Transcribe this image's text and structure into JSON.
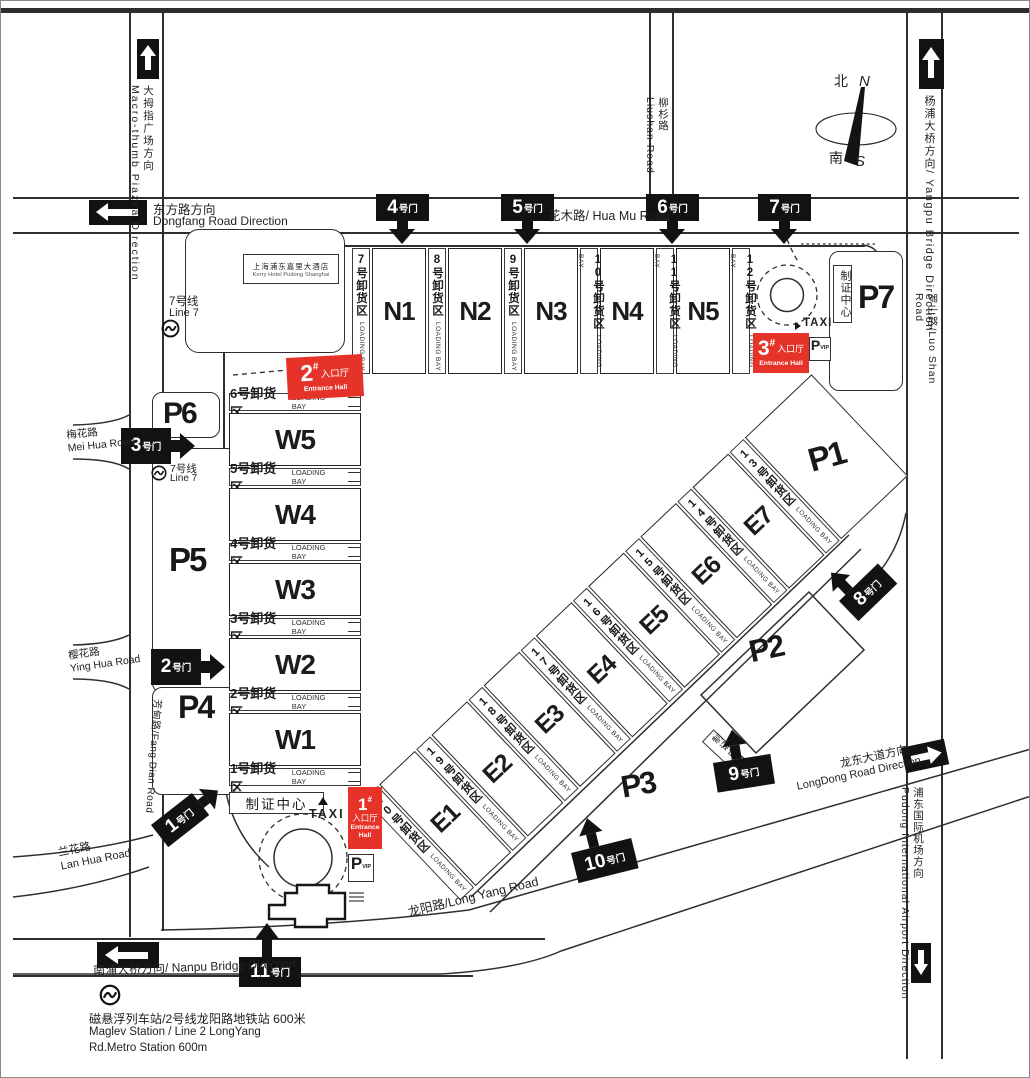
{
  "colors": {
    "red": "#e5332a",
    "ink": "#121212"
  },
  "compass": {
    "north_cn": "北",
    "north_en": "N",
    "south_cn": "南",
    "south_en": "S"
  },
  "roads": {
    "macro_thumb": "大拇指广场方向\nMacro-thumb Piazza Direction",
    "dongfang_cn": "东方路方向",
    "dongfang_en": "Dongfang Road Direction",
    "huamu": "花木路/ Hua Mu Road",
    "liushan": "柳杉路\nLiushan Road",
    "yangpu": "杨浦大桥方向/ Yangpu Bridge Direction",
    "luoshan": "罗山路/Luo Shan Road",
    "meihua": "梅花路\nMei Hua Road",
    "yinghua": "樱花路\nYing Hua Road",
    "fangdian": "芳甸路/Fang Dian Road",
    "lanhua": "兰花路\nLan Hua Road",
    "nanpu": "南浦大桥方向/ Nanpu Bridge Direction",
    "longyang": "龙阳路/Long Yang Road",
    "longdong_cn": "龙东大道方向",
    "longdong_en": "LongDong Road Direction",
    "airport": "浦东国际机场方向\nPudong International Airport Direction"
  },
  "landmarks": {
    "hotel_cn": "上海浦东嘉里大酒店",
    "hotel_en": "Kerry Hotel Pudong Shanghai",
    "line7_cn": "7号线",
    "line7_en": "Line 7",
    "maglev_cn": "磁悬浮列车站/2号线龙阳路地铁站  600米",
    "maglev_en1": "Maglev Station  / Line 2 LongYang",
    "maglev_en2": "Rd.Metro Station 600m",
    "taxi": "TAXI",
    "badge_center": "制证中心",
    "vip_p": "P",
    "vip": "VIP"
  },
  "parking": {
    "p1": "P1",
    "p2": "P2",
    "p3": "P3",
    "p4": "P4",
    "p5": "P5",
    "p6": "P6",
    "p7": "P7"
  },
  "halls": {
    "n": [
      "N1",
      "N2",
      "N3",
      "N4",
      "N5"
    ],
    "w": [
      "W5",
      "W4",
      "W3",
      "W2",
      "W1"
    ],
    "e": [
      "E1",
      "E2",
      "E3",
      "E4",
      "E5",
      "E6",
      "E7"
    ]
  },
  "bays": {
    "n": [
      {
        "cn": "7号卸货区",
        "en": "LOADING BAY"
      },
      {
        "cn": "8号卸货区",
        "en": "LOADING BAY"
      },
      {
        "cn": "9号卸货区",
        "en": "LOADING BAY"
      },
      {
        "cn": "10号卸货区",
        "en": "LOADING BAY"
      },
      {
        "cn": "11号卸货区",
        "en": "LOADING BAY"
      },
      {
        "cn": "12号卸货区",
        "en": "LOADING BAY"
      }
    ],
    "w": [
      {
        "cn": "6号卸货区",
        "en": "LOADING BAY"
      },
      {
        "cn": "5号卸货区",
        "en": "LOADING BAY"
      },
      {
        "cn": "4号卸货区",
        "en": "LOADING BAY"
      },
      {
        "cn": "3号卸货区",
        "en": "LOADING BAY"
      },
      {
        "cn": "2号卸货区",
        "en": "LOADING BAY"
      },
      {
        "cn": "1号卸货区",
        "en": "LOADING BAY"
      }
    ],
    "e": [
      {
        "cn": "20号卸货区",
        "en": "LOADING BAY"
      },
      {
        "cn": "19号卸货区",
        "en": "LOADING BAY"
      },
      {
        "cn": "18号卸货区",
        "en": "LOADING BAY"
      },
      {
        "cn": "17号卸货区",
        "en": "LOADING BAY"
      },
      {
        "cn": "16号卸货区",
        "en": "LOADING BAY"
      },
      {
        "cn": "15号卸货区",
        "en": "LOADING BAY"
      },
      {
        "cn": "14号卸货区",
        "en": "LOADING BAY"
      },
      {
        "cn": "13号卸货区",
        "en": "LOADING BAY"
      }
    ]
  },
  "gates": [
    {
      "num": "1",
      "suffix": "号门"
    },
    {
      "num": "2",
      "suffix": "号门"
    },
    {
      "num": "3",
      "suffix": "号门"
    },
    {
      "num": "4",
      "suffix": "号门"
    },
    {
      "num": "5",
      "suffix": "号门"
    },
    {
      "num": "6",
      "suffix": "号门"
    },
    {
      "num": "7",
      "suffix": "号门"
    },
    {
      "num": "8",
      "suffix": "号门"
    },
    {
      "num": "9",
      "suffix": "号门"
    },
    {
      "num": "10",
      "suffix": "号门"
    },
    {
      "num": "11",
      "suffix": "号门"
    }
  ],
  "entrances": [
    {
      "num": "1",
      "hash": "#",
      "cn": "入口厅",
      "en": "Entrance Hall"
    },
    {
      "num": "2",
      "hash": "#",
      "cn": "入口厅",
      "en": "Entrance Hall"
    },
    {
      "num": "3",
      "hash": "#",
      "cn": "入口厅",
      "en": "Entrance Hall"
    }
  ]
}
